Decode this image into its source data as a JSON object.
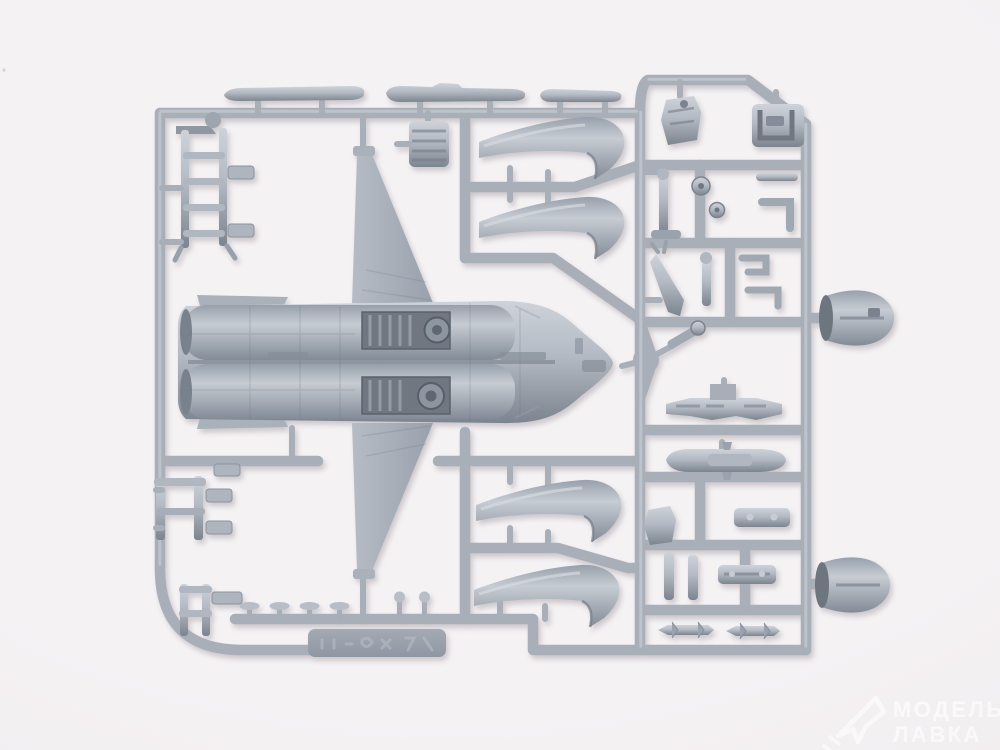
{
  "meta": {
    "kind": "photograph",
    "subject": "Gray injection-molded plastic model kit sprue with 1/72 jet fighter parts on a white background",
    "shop_stamp": "bottom-right semi-transparent watermark"
  },
  "palette": {
    "bg_center": "#f5f2f4",
    "bg_edge": "#edeaec",
    "runner": "#a9afb8",
    "plastic_base": "#9aa2ad",
    "plastic_light": "#ced3da",
    "plastic_dark": "#7c848f",
    "recess": "#6f7780",
    "shadow": "#a49da3"
  },
  "watermark": {
    "line1": "МОДЕЛЬНАЯ",
    "line2": "ЛАВКА",
    "logo": "paper-plane-icon"
  },
  "sprue": {
    "embossed_tab": "illegible raised mould lettering",
    "parts": [
      {
        "label": "lower fuselage half with wings"
      },
      {
        "label": "upper wing panel"
      },
      {
        "label": "lower wing panel"
      },
      {
        "label": "engine intake duct (upper left)"
      },
      {
        "label": "engine intake duct (upper right)"
      },
      {
        "label": "engine intake duct (lower left)"
      },
      {
        "label": "engine intake duct (lower right)"
      },
      {
        "label": "exhaust nozzle cone (upper)"
      },
      {
        "label": "exhaust nozzle cone (lower)"
      },
      {
        "label": "boarding ladder"
      },
      {
        "label": "flap rail (long, left)"
      },
      {
        "label": "flap rail (long, center)"
      },
      {
        "label": "flap rail (short, right)"
      },
      {
        "label": "afterburner section block"
      },
      {
        "label": "ejection seat"
      },
      {
        "label": "cockpit tub"
      },
      {
        "label": "main landing gear strut"
      },
      {
        "label": "wheels"
      },
      {
        "label": "gun / small strut"
      },
      {
        "label": "nose gear strut"
      },
      {
        "label": "weapons pylon"
      },
      {
        "label": "drop tank"
      },
      {
        "label": "launch rail plate (upper)"
      },
      {
        "label": "launch rail plate (lower)"
      },
      {
        "label": "missile (left)"
      },
      {
        "label": "missile (right)"
      },
      {
        "label": "landing gear door frame"
      },
      {
        "label": "small access frame"
      },
      {
        "label": "antenna mushroom pins"
      }
    ]
  }
}
